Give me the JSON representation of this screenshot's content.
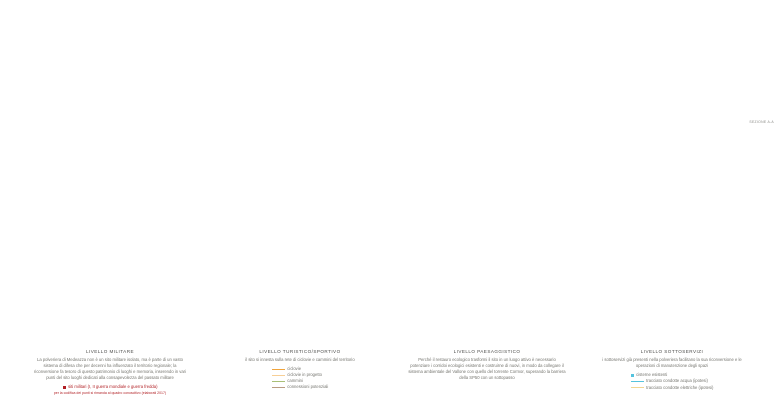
{
  "section": {
    "label": "SEZIONE A-A"
  },
  "panels": [
    {
      "title": "LIVELLO MILITARE",
      "body": "La polveriera di Medeazza non è un sito militare isolato, ma è parte di un vasto sistema di difesa che per decenni ha influenzato il territorio regionale; la riconversione fa tesoro di questo patrimonio di luoghi e memoria, inserendo in vari punti del sito luoghi dedicati alla consapevolezza del passato militare",
      "legend": [
        {
          "label": "siti militari (I, II guerra mondiale e guerra fredda)",
          "color": "#b11f24",
          "note": "per la codifica dei punti si rimanda al quadro conoscitivo (elaborati 2017)"
        }
      ]
    },
    {
      "title": "LIVELLO TURISTICO/SPORTIVO",
      "body": "il sito si innesta sulla rete di ciclovie e cammini del territorio",
      "legend": [
        {
          "label": "ciclovie",
          "color": "#f0a43c"
        },
        {
          "label": "ciclovie in progetto",
          "color": "#f7cf96"
        },
        {
          "label": "cammini",
          "color": "#a9c077"
        },
        {
          "label": "connessioni potenziali",
          "color": "#b99b82"
        }
      ]
    },
    {
      "title": "LIVELLO PAESAGGISTICO",
      "body": "Perché il restauro ecologico trasformi il sito in un luogo attivo è necessario potenziare i corridoi ecologici esistenti e costruirne di nuovi, in modo da collegare il sistema ambientale del Vallone con quello del torrente Cormor, superando la barriera della SP50 con un sottopasso",
      "legend": []
    },
    {
      "title": "LIVELLO SOTTOSERVIZI",
      "body": "i sottoservizi già presenti nella polveriera facilitano la sua riconversione e le operazioni di manutenzione degli spazi",
      "legend": [
        {
          "label": "cisterne esistenti",
          "color": "#55c3de",
          "swatch": "square"
        },
        {
          "label": "tracciato condotte acqua (ipotesi)",
          "color": "#55c3de",
          "swatch": "line"
        },
        {
          "label": "tracciato condotte elettriche (ipotesi)",
          "color": "#f2d692",
          "swatch": "line"
        }
      ]
    }
  ],
  "colors": {
    "accent_red": "#b11f24",
    "cycleway_orange": "#f0a43c",
    "cycleway_planned_orange": "#f7cf96",
    "paths_green": "#a9c077",
    "connections_brown": "#b99b82",
    "water_cyan": "#55c3de",
    "electric_yellow": "#f2d692",
    "site_green": "#bac890",
    "site_green_border": "#7f9152",
    "river_blue": "#bdc8cf",
    "pale_green": "#e8edda",
    "teal_line": "#2ea49c",
    "parcel_tan": "#c99a5f"
  }
}
